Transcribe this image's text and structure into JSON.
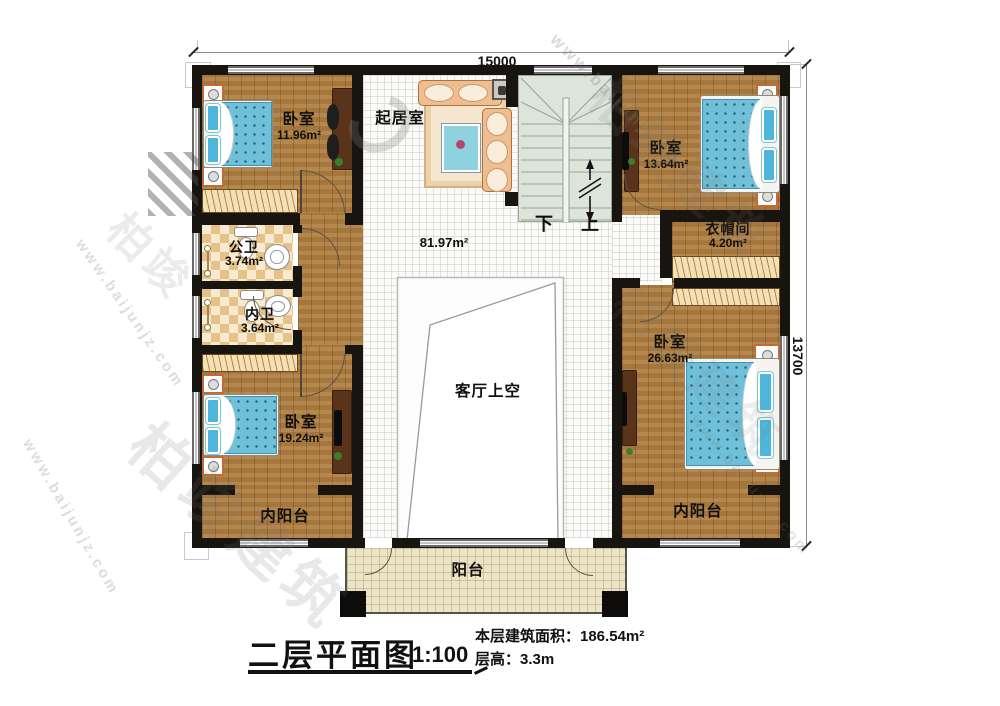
{
  "title_block": {
    "title": "二层平面图",
    "scale": "1:100",
    "area_line": "本层建筑面积：186.54m²",
    "height_line": "层高：3.3m"
  },
  "dimensions": {
    "width": "15000",
    "height": "13700"
  },
  "stairs": {
    "down": "下",
    "up": "上"
  },
  "rooms": {
    "bedroom_tl": {
      "name": "卧室",
      "area": "11.96m²"
    },
    "living": {
      "name": "起居室"
    },
    "hall": {
      "area": "81.97m²"
    },
    "bedroom_tr": {
      "name": "卧室",
      "area": "13.64m²"
    },
    "cloakroom": {
      "name": "衣帽间",
      "area": "4.20m²"
    },
    "bath_public": {
      "name": "公卫",
      "area": "3.74m²"
    },
    "bath_private": {
      "name": "内卫",
      "area": "3.64m²"
    },
    "bedroom_bl": {
      "name": "卧室",
      "area": "19.24m²"
    },
    "bedroom_br": {
      "name": "卧室",
      "area": "26.63m²"
    },
    "void": {
      "name": "客厅上空"
    },
    "inner_balcony_left": {
      "name": "内阳台"
    },
    "inner_balcony_right": {
      "name": "内阳台"
    },
    "balcony": {
      "name": "阳台"
    }
  },
  "watermark": {
    "site": "www.baijunjz.com",
    "brand": "柏竣建筑",
    "brand_short": "柏竣"
  }
}
